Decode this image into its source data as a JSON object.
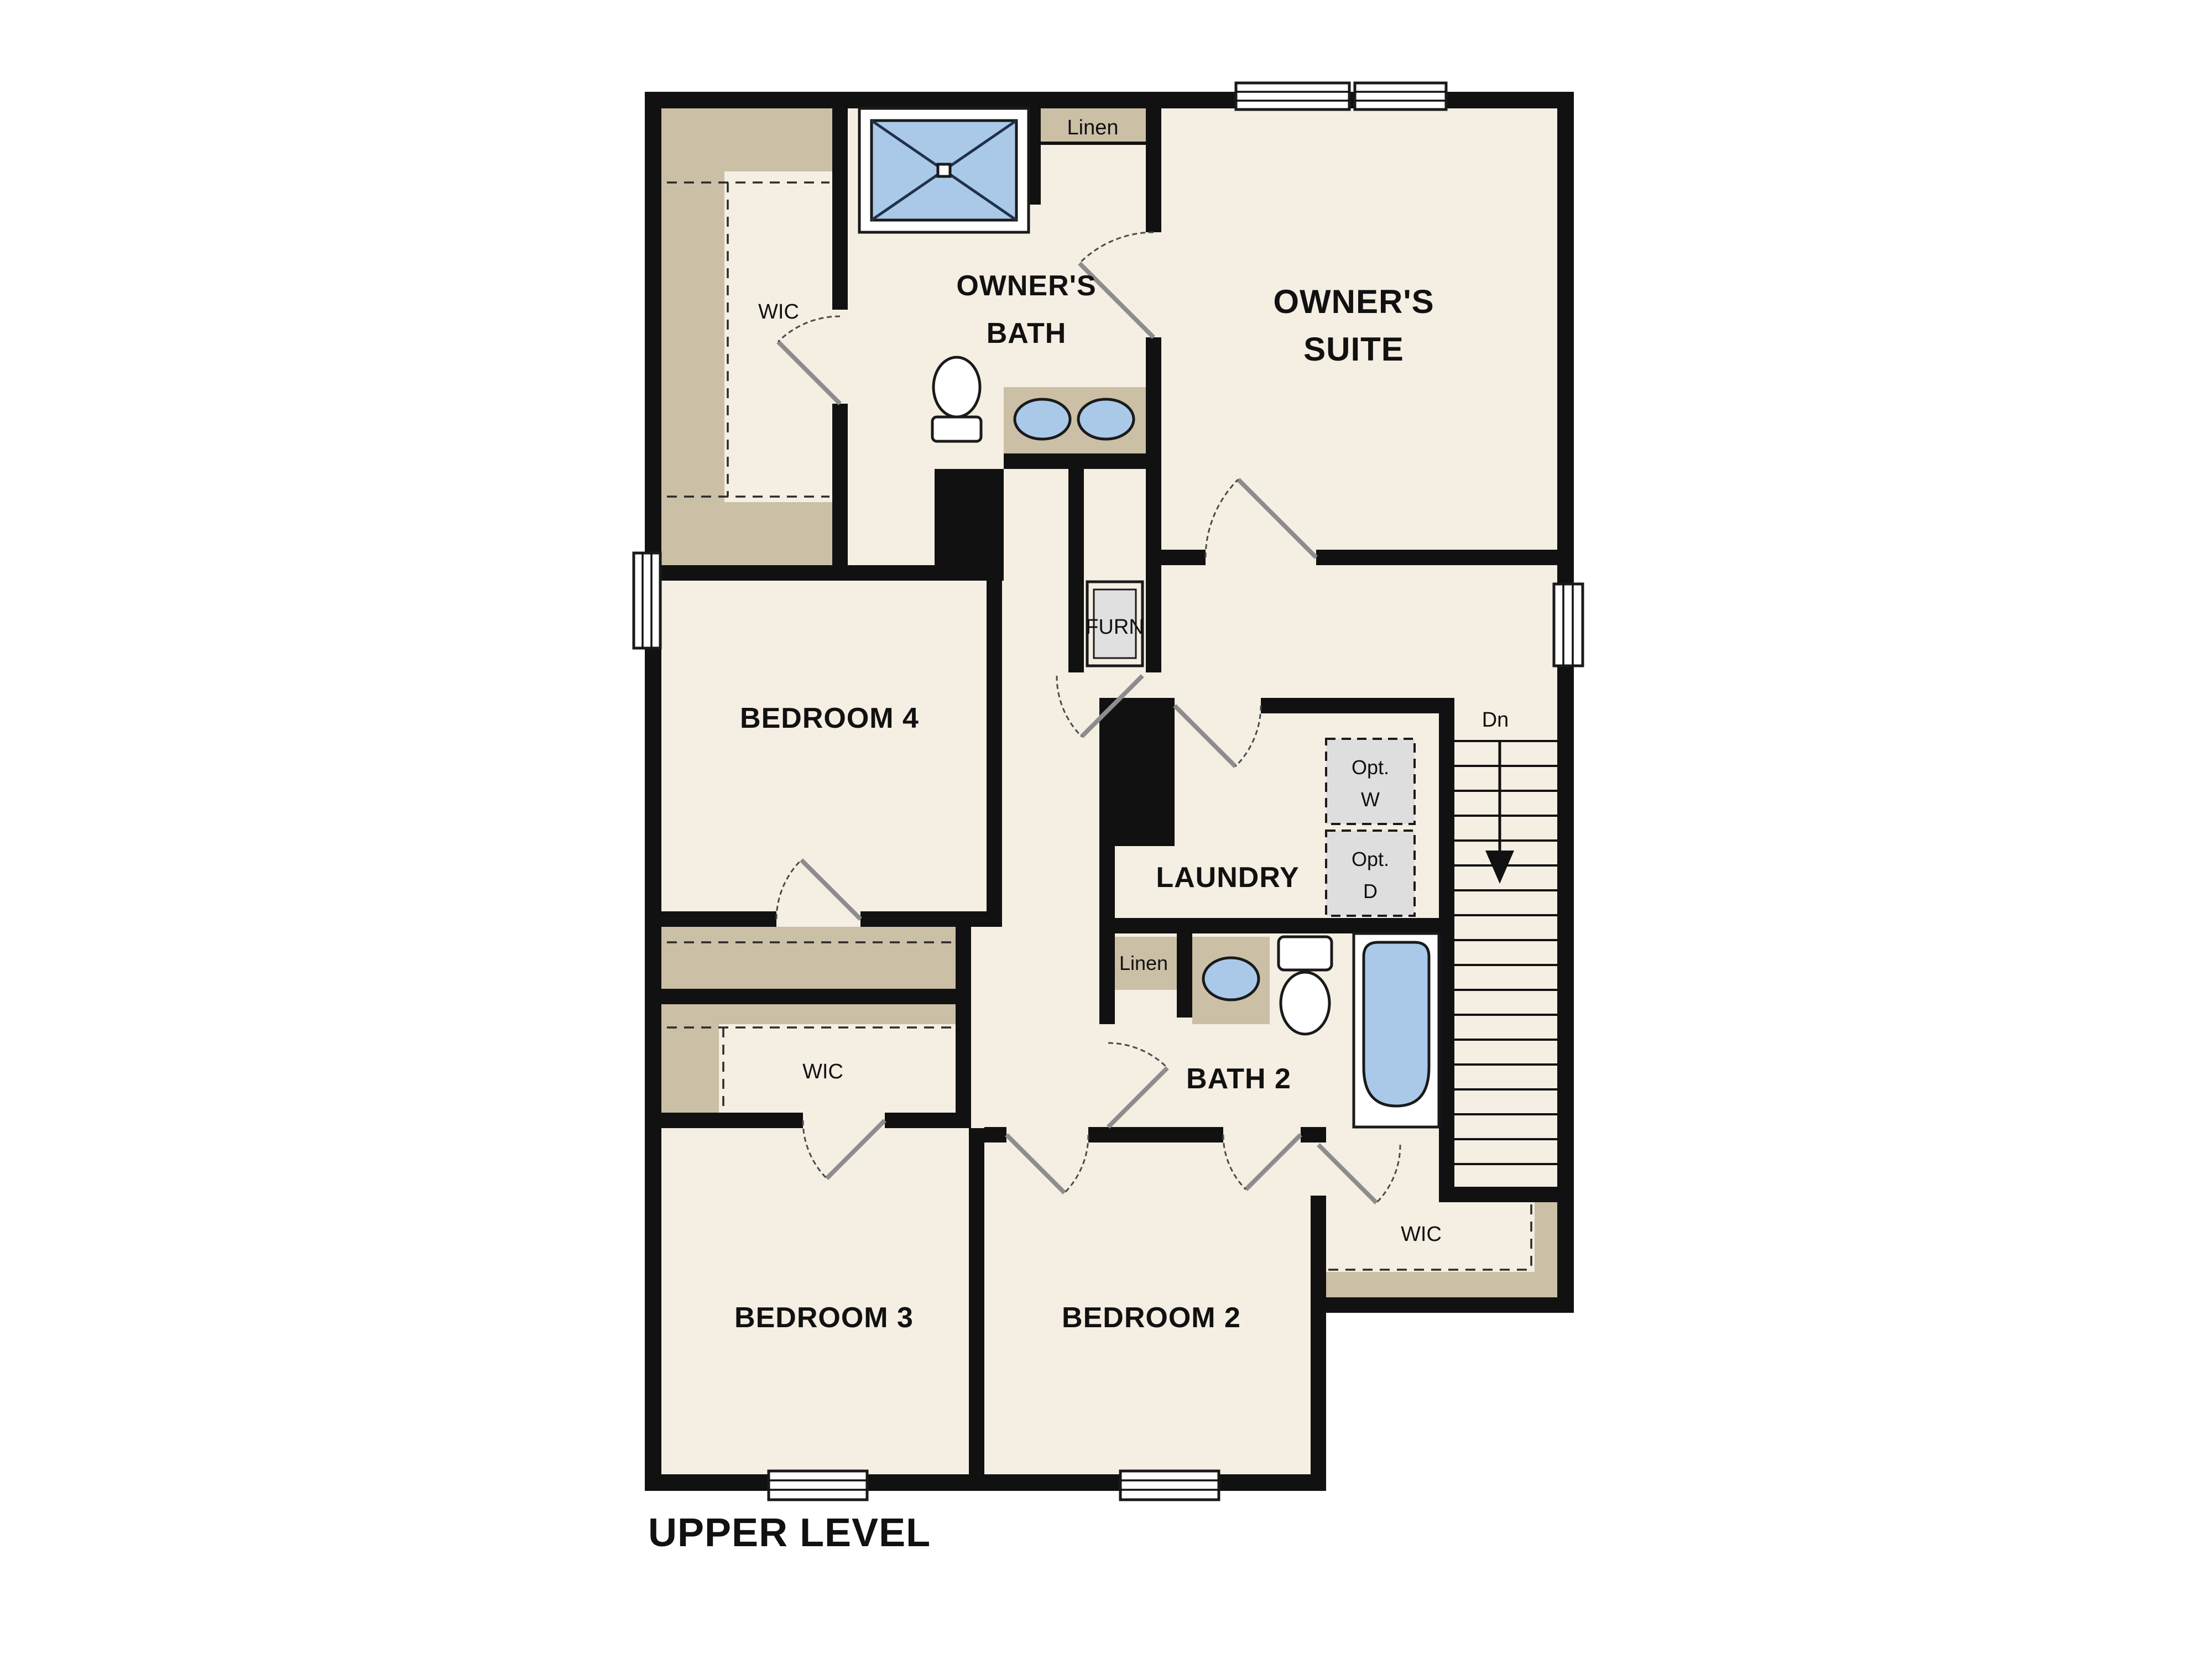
{
  "plan": {
    "level_title": "UPPER LEVEL",
    "palette": {
      "floor": "#f5eee2",
      "wall": "#111111",
      "closet_tan": "#cbbfa6",
      "fixture_blue": "#aac9e9",
      "optional_gray": "#dedede",
      "background": "#ffffff"
    },
    "labels": {
      "upper_level": "UPPER LEVEL",
      "owners_suite_line1": "OWNER'S",
      "owners_suite_line2": "SUITE",
      "owners_bath_line1": "OWNER'S",
      "owners_bath_line2": "BATH",
      "bedroom_4": "BEDROOM 4",
      "bedroom_3": "BEDROOM 3",
      "bedroom_2": "BEDROOM 2",
      "laundry": "LAUNDRY",
      "bath_2": "BATH 2",
      "wic_owners": "WIC",
      "wic_bedroom3": "WIC",
      "wic_bedroom2": "WIC",
      "linen_upper": "Linen",
      "linen_bath2": "Linen",
      "furnace": "FURN",
      "stairs_down": "Dn",
      "opt_washer_line1": "Opt.",
      "opt_washer_line2": "W",
      "opt_dryer_line1": "Opt.",
      "opt_dryer_line2": "D"
    }
  }
}
